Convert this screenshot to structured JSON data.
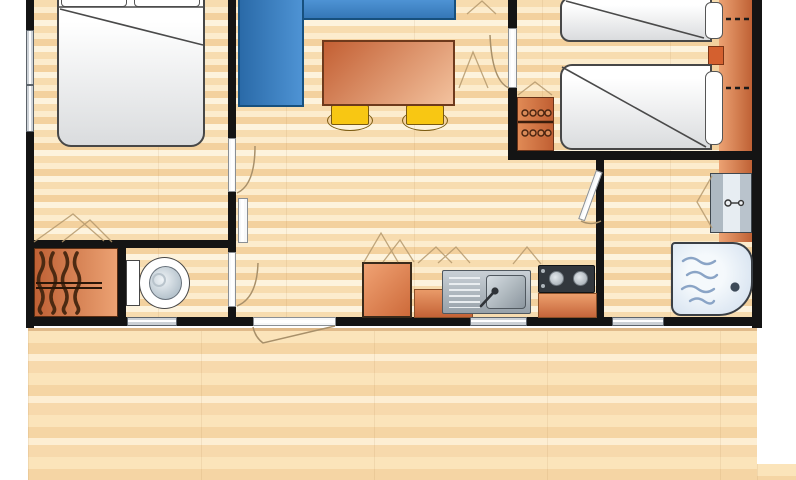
{
  "figure": {
    "kind": "floor-plan",
    "description_elements": [
      {
        "id": "double-bedroom",
        "items": [
          "double-bed",
          "pillows",
          "side-windows"
        ]
      },
      {
        "id": "living-area",
        "items": [
          "corner-sofa",
          "dining-table",
          "stool",
          "stool"
        ]
      },
      {
        "id": "twin-bedroom",
        "items": [
          "twin-bed",
          "twin-bed",
          "pillows",
          "nightstand",
          "headboard-shelf",
          "wardrobe"
        ]
      },
      {
        "id": "toilet-room",
        "items": [
          "toilet",
          "window"
        ]
      },
      {
        "id": "hall-wardrobe",
        "items": [
          "hanging-closet"
        ]
      },
      {
        "id": "kitchen",
        "items": [
          "fridge",
          "counter",
          "sink-with-drainer",
          "faucet",
          "hob-two-burners",
          "counter",
          "overhead-cupboard-sketches",
          "window"
        ]
      },
      {
        "id": "shower-room",
        "items": [
          "washbasin-cabinet",
          "shower-tray",
          "drain",
          "window"
        ]
      },
      {
        "id": "terrace-deck",
        "items": [
          "entrance-door-swing",
          "wood-planks"
        ]
      }
    ],
    "doors": [
      "double-bedroom-door",
      "toilet-door",
      "twin-bedroom-door",
      "shower-room-door",
      "entrance-door"
    ],
    "windows_count": 5
  },
  "palette": {
    "wall": "#141414",
    "floor_light": "#fceccd",
    "floor_mid": "#f7dcaf",
    "floor_dark": "#f3d19e",
    "deck_light": "#fdeed3",
    "deck_mid": "#fbe4ba",
    "sofa_blue": "#3b82c4",
    "sofa_border": "#17507e",
    "furniture_orange_dark": "#bf6135",
    "furniture_orange_light": "#eca273",
    "table_dark": "#c35f33",
    "table_light": "#f3c29e",
    "stool_yellow": "#f8c713",
    "fixture_white": "#ffffff",
    "steel_gray": "#97a1a9",
    "water_blue": "#8aa4c6",
    "window_gray": "#ccd1d6",
    "sketch_line": "#b09272"
  }
}
